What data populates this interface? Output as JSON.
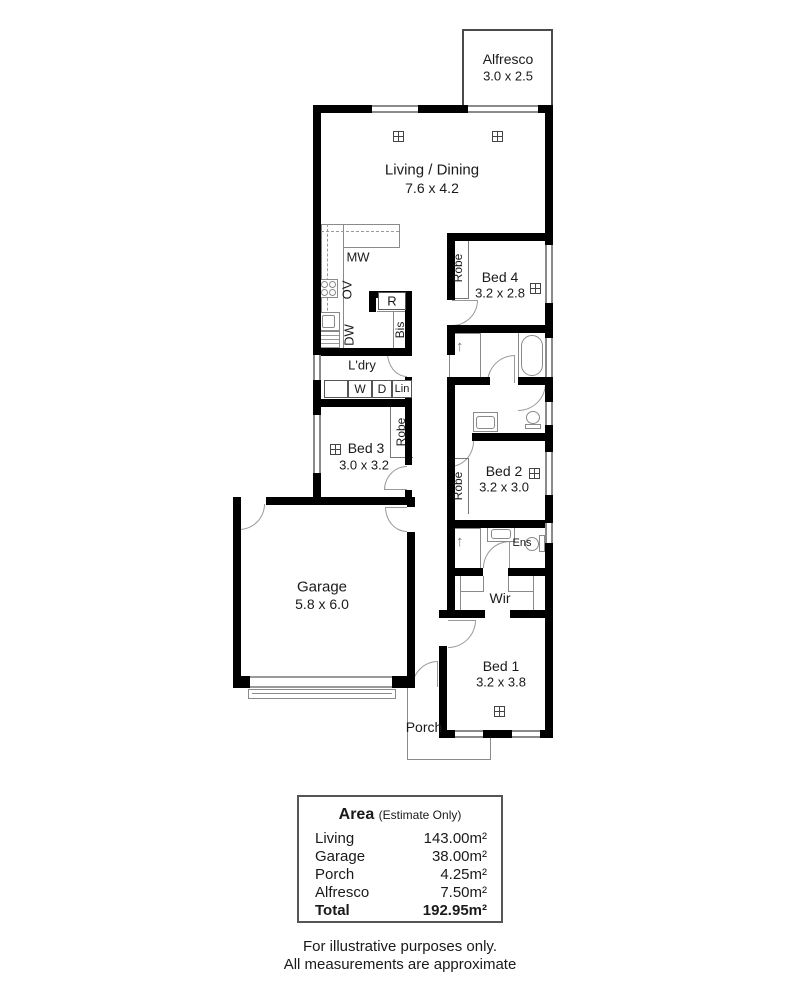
{
  "colors": {
    "wall": "#000000",
    "fixture_line": "#8a8a8a",
    "text": "#1a1a1a",
    "background": "#ffffff"
  },
  "rooms": {
    "alfresco": {
      "name": "Alfresco",
      "dims": "3.0 x 2.5"
    },
    "living_dining": {
      "name": "Living / Dining",
      "dims": "7.6 x 4.2"
    },
    "bed4": {
      "name": "Bed 4",
      "dims": "3.2 x 2.8"
    },
    "bed3": {
      "name": "Bed 3",
      "dims": "3.0 x 3.2"
    },
    "bed2": {
      "name": "Bed 2",
      "dims": "3.2 x 3.0"
    },
    "bed1": {
      "name": "Bed 1",
      "dims": "3.2 x 3.8"
    },
    "garage": {
      "name": "Garage",
      "dims": "5.8 x 6.0"
    },
    "laundry": {
      "name": "L'dry"
    },
    "wir": {
      "name": "Wir"
    },
    "ens": {
      "name": "Ens"
    },
    "porch": {
      "name": "Porch"
    }
  },
  "fixtures": {
    "mw": "MW",
    "ov": "OV",
    "dw": "DW",
    "fridge": "R",
    "bis": "Bis",
    "washer": "W",
    "dryer": "D",
    "linen": "Lin",
    "robe": "Robe"
  },
  "area_table": {
    "title": "Area",
    "subtitle": "(Estimate Only)",
    "rows": [
      {
        "label": "Living",
        "value": "143.00m²"
      },
      {
        "label": "Garage",
        "value": "38.00m²"
      },
      {
        "label": "Porch",
        "value": "4.25m²"
      },
      {
        "label": "Alfresco",
        "value": "7.50m²"
      }
    ],
    "total_label": "Total",
    "total_value": "192.95m²"
  },
  "footer": {
    "line1": "For illustrative purposes only.",
    "line2": "All measurements are approximate"
  }
}
